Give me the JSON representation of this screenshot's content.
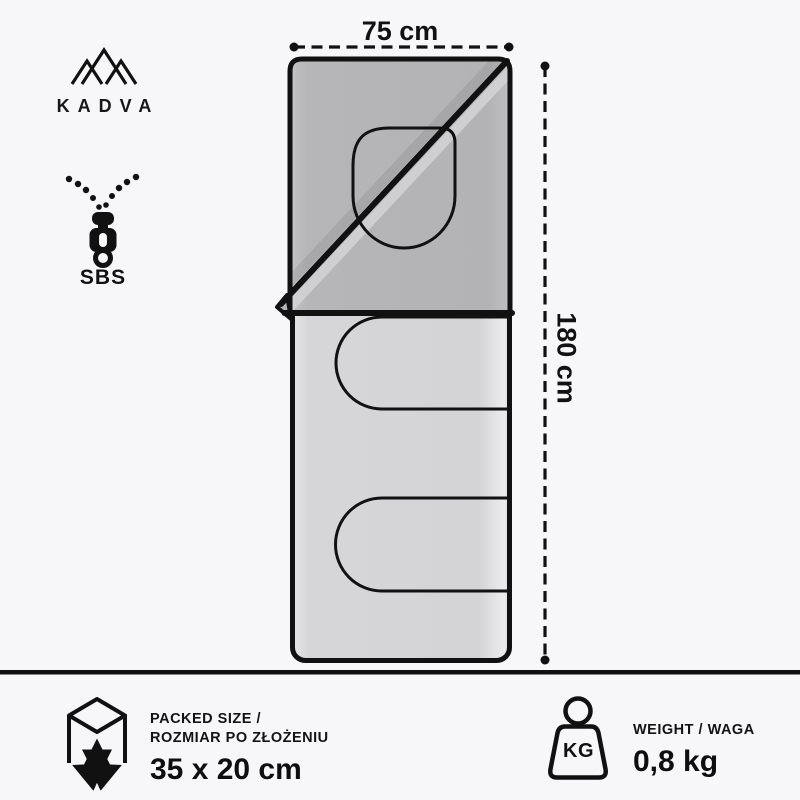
{
  "brand": {
    "name": "KADVA"
  },
  "features": {
    "zipper_brand": "SBS"
  },
  "diagram": {
    "width_label": "75 cm",
    "height_label": "180 cm"
  },
  "footer": {
    "packed": {
      "title_line1": "PACKED SIZE /",
      "title_line2": "ROZMIAR PO ZŁOŻENIU",
      "value": "35 x 20 cm"
    },
    "weight": {
      "title": "WEIGHT / WAGA",
      "value": "0,8 kg",
      "icon_label": "KG"
    }
  },
  "colors": {
    "background": "#f7f7f9",
    "ink": "#111111",
    "flap_gray": "#b5b5b7",
    "body_gray": "#d8d8da"
  }
}
